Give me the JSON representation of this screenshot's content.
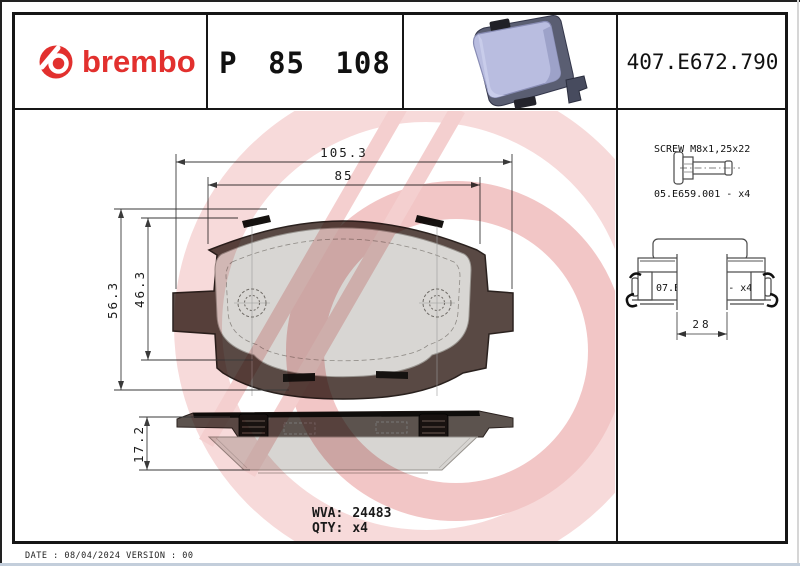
{
  "header": {
    "brand": "brembo",
    "part_number": "P 85 108",
    "catalog_number": "407.E672.790"
  },
  "right_panel": {
    "screw_line1": "SCREW M8x1,25x22",
    "screw_line2": "05.E659.001 - x4",
    "clip_line1": "CLIP SPRING",
    "clip_line2": "07.E658.047 - x4",
    "clip_width_dim": "28"
  },
  "drawing": {
    "dim_width_outer": "105.3",
    "dim_width_inner": "85",
    "dim_height_outer": "56.3",
    "dim_height_inner": "46.3",
    "dim_thickness": "17.2"
  },
  "footer": {
    "wva_label": "WVA:",
    "wva_value": "24483",
    "qty_label": "QTY:",
    "qty_value": "x4",
    "date_line": "DATE : 08/04/2024 VERSION : 00"
  },
  "colors": {
    "brand_red": "#e2302e",
    "backing_plate": "#594944",
    "friction_material": "#d8d6d3",
    "watermark_pink": "#f6d6d6",
    "pad_render_face": "#b9bde0"
  }
}
